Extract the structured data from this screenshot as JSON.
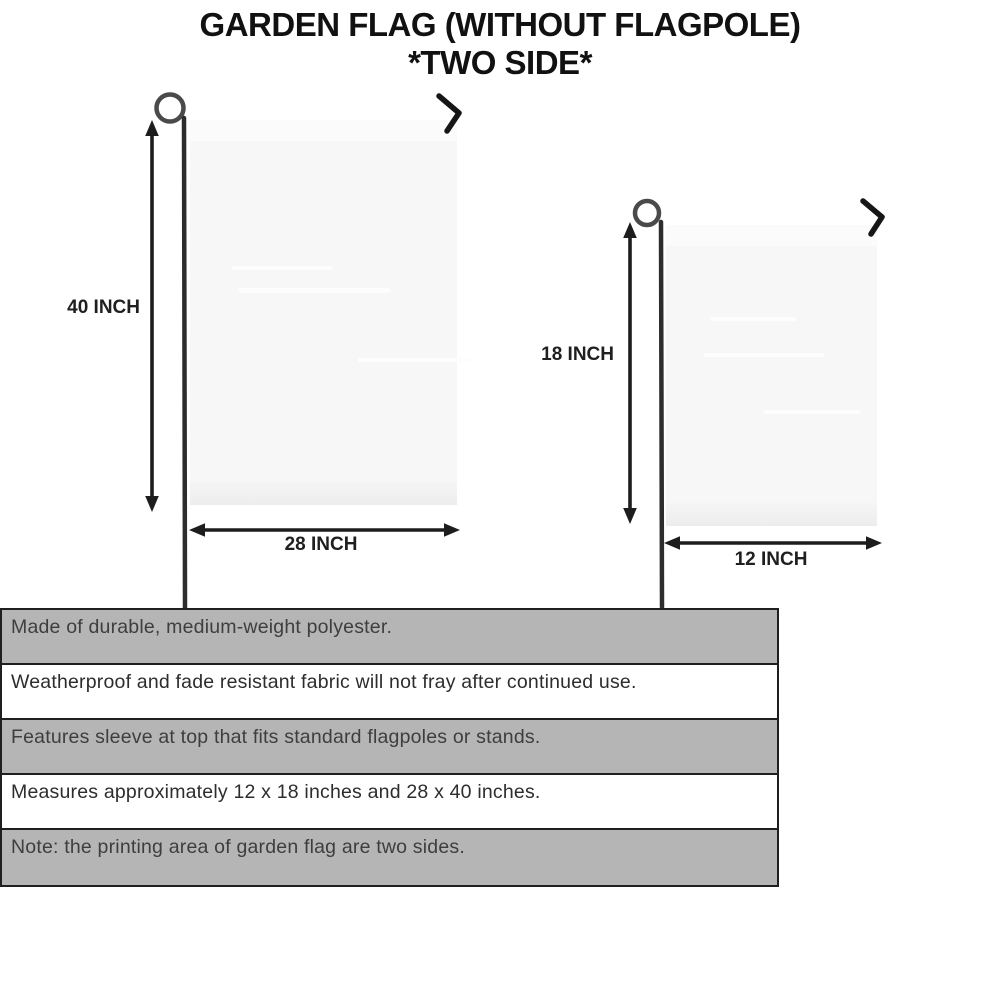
{
  "title": {
    "line1": "GARDEN FLAG (WITHOUT FLAGPOLE)",
    "line2": "*TWO SIDE*"
  },
  "large_flag": {
    "height_label": "40 INCH",
    "width_label": "28 INCH"
  },
  "small_flag": {
    "height_label": "18 INCH",
    "width_label": "12 INCH"
  },
  "features": [
    {
      "text": "Made of durable, medium-weight polyester."
    },
    {
      "text": "Weatherproof and fade resistant fabric will not fray after continued use."
    },
    {
      "text": "Features sleeve at top that fits standard flagpoles or stands."
    },
    {
      "text": "Measures approximately 12 x 18 inches and 28 x 40 inches."
    },
    {
      "text": "Note: the printing area of garden flag are two sides."
    }
  ],
  "colors": {
    "bar_gray": "#b5b5b5",
    "border_dark": "#1f1f1f",
    "flag_fill": "#f7f7f7",
    "title_black": "#111111"
  }
}
